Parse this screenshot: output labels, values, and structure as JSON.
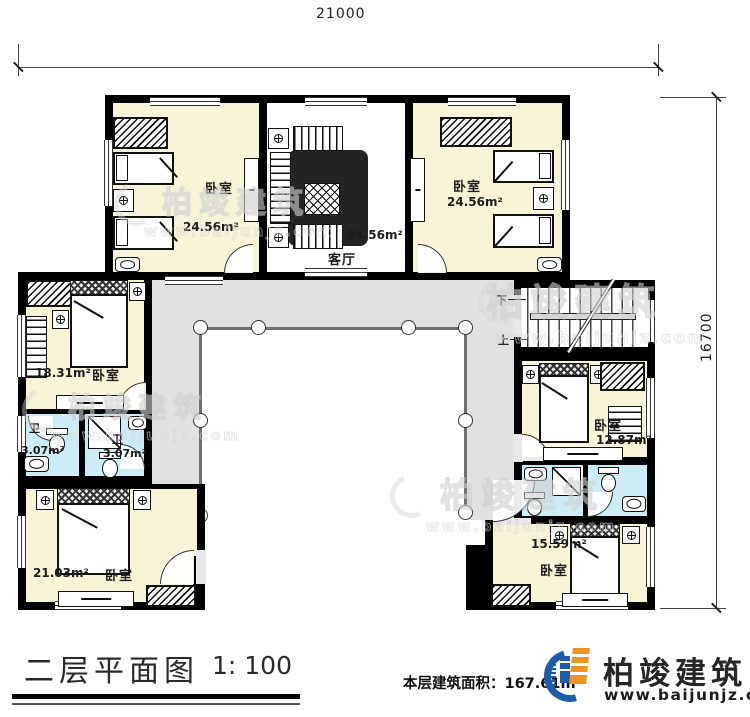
{
  "dimensions": {
    "width_mm": "21000",
    "height_mm": "16700"
  },
  "rooms": {
    "nw_bedroom": {
      "label": "卧室",
      "area": "24.56m²"
    },
    "living_room": {
      "label": "客厅",
      "area": "24.56m²"
    },
    "ne_bedroom": {
      "label": "卧室",
      "area": "24.56m²"
    },
    "west_bedroom": {
      "label": "卧室",
      "area": "18.31m²"
    },
    "bath_left": {
      "label": "卫",
      "area": "3.07m²"
    },
    "bath_right": {
      "label": "卫",
      "area": "3.07m²"
    },
    "sw_bedroom": {
      "label": "卧室",
      "area": "21.03m²"
    },
    "east_bedroom": {
      "label": "卧室",
      "area": "12.87m²"
    },
    "se_bedroom": {
      "label": "卧室",
      "area": "15.59m²"
    }
  },
  "stairs": {
    "down_label": "下",
    "up_label": "上"
  },
  "title_block": {
    "title": "二层平面图",
    "scale": "1: 100",
    "floor_area": "本层建筑面积：167.61m²"
  },
  "logo": {
    "company": "柏竣建筑",
    "website": "www.baijunjz.com"
  },
  "watermark": {
    "company": "柏竣建筑",
    "website": "www.baijunjz.com"
  },
  "colors": {
    "bedroom_floor": "#f8f4d8",
    "bath_floor": "#cdedf6",
    "corridor": "#e1e1e1",
    "logo_blue": "#1b5cab",
    "logo_orange": "#f0931f"
  }
}
